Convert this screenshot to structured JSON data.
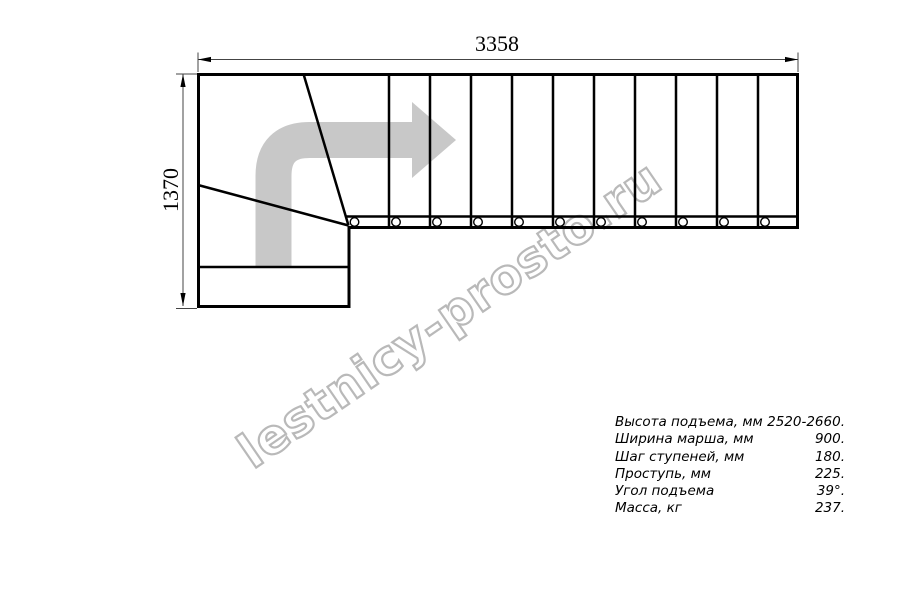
{
  "drawing": {
    "type": "staircase-plan-top-view",
    "dimensions": {
      "width_label": "3358",
      "height_label": "1370"
    },
    "straight_tread_count": 11,
    "winder_tread_count": 2,
    "colors": {
      "line": "#000000",
      "dimension_line": "#444444",
      "arrow": "#c8c8c8",
      "watermark_outline": "#b9b9b9"
    }
  },
  "watermark": {
    "text": "lestnicy-prosto.ru"
  },
  "specs": {
    "rows": [
      {
        "label": "Высота подъема, мм",
        "value": "2520-2660."
      },
      {
        "label": "Ширина марша, мм",
        "value": "900."
      },
      {
        "label": "Шаг ступеней, мм",
        "value": "180."
      },
      {
        "label": "Проступь, мм",
        "value": "225."
      },
      {
        "label": "Угол подъема",
        "value": "39°."
      },
      {
        "label": "Масса, кг",
        "value": "237."
      }
    ]
  }
}
